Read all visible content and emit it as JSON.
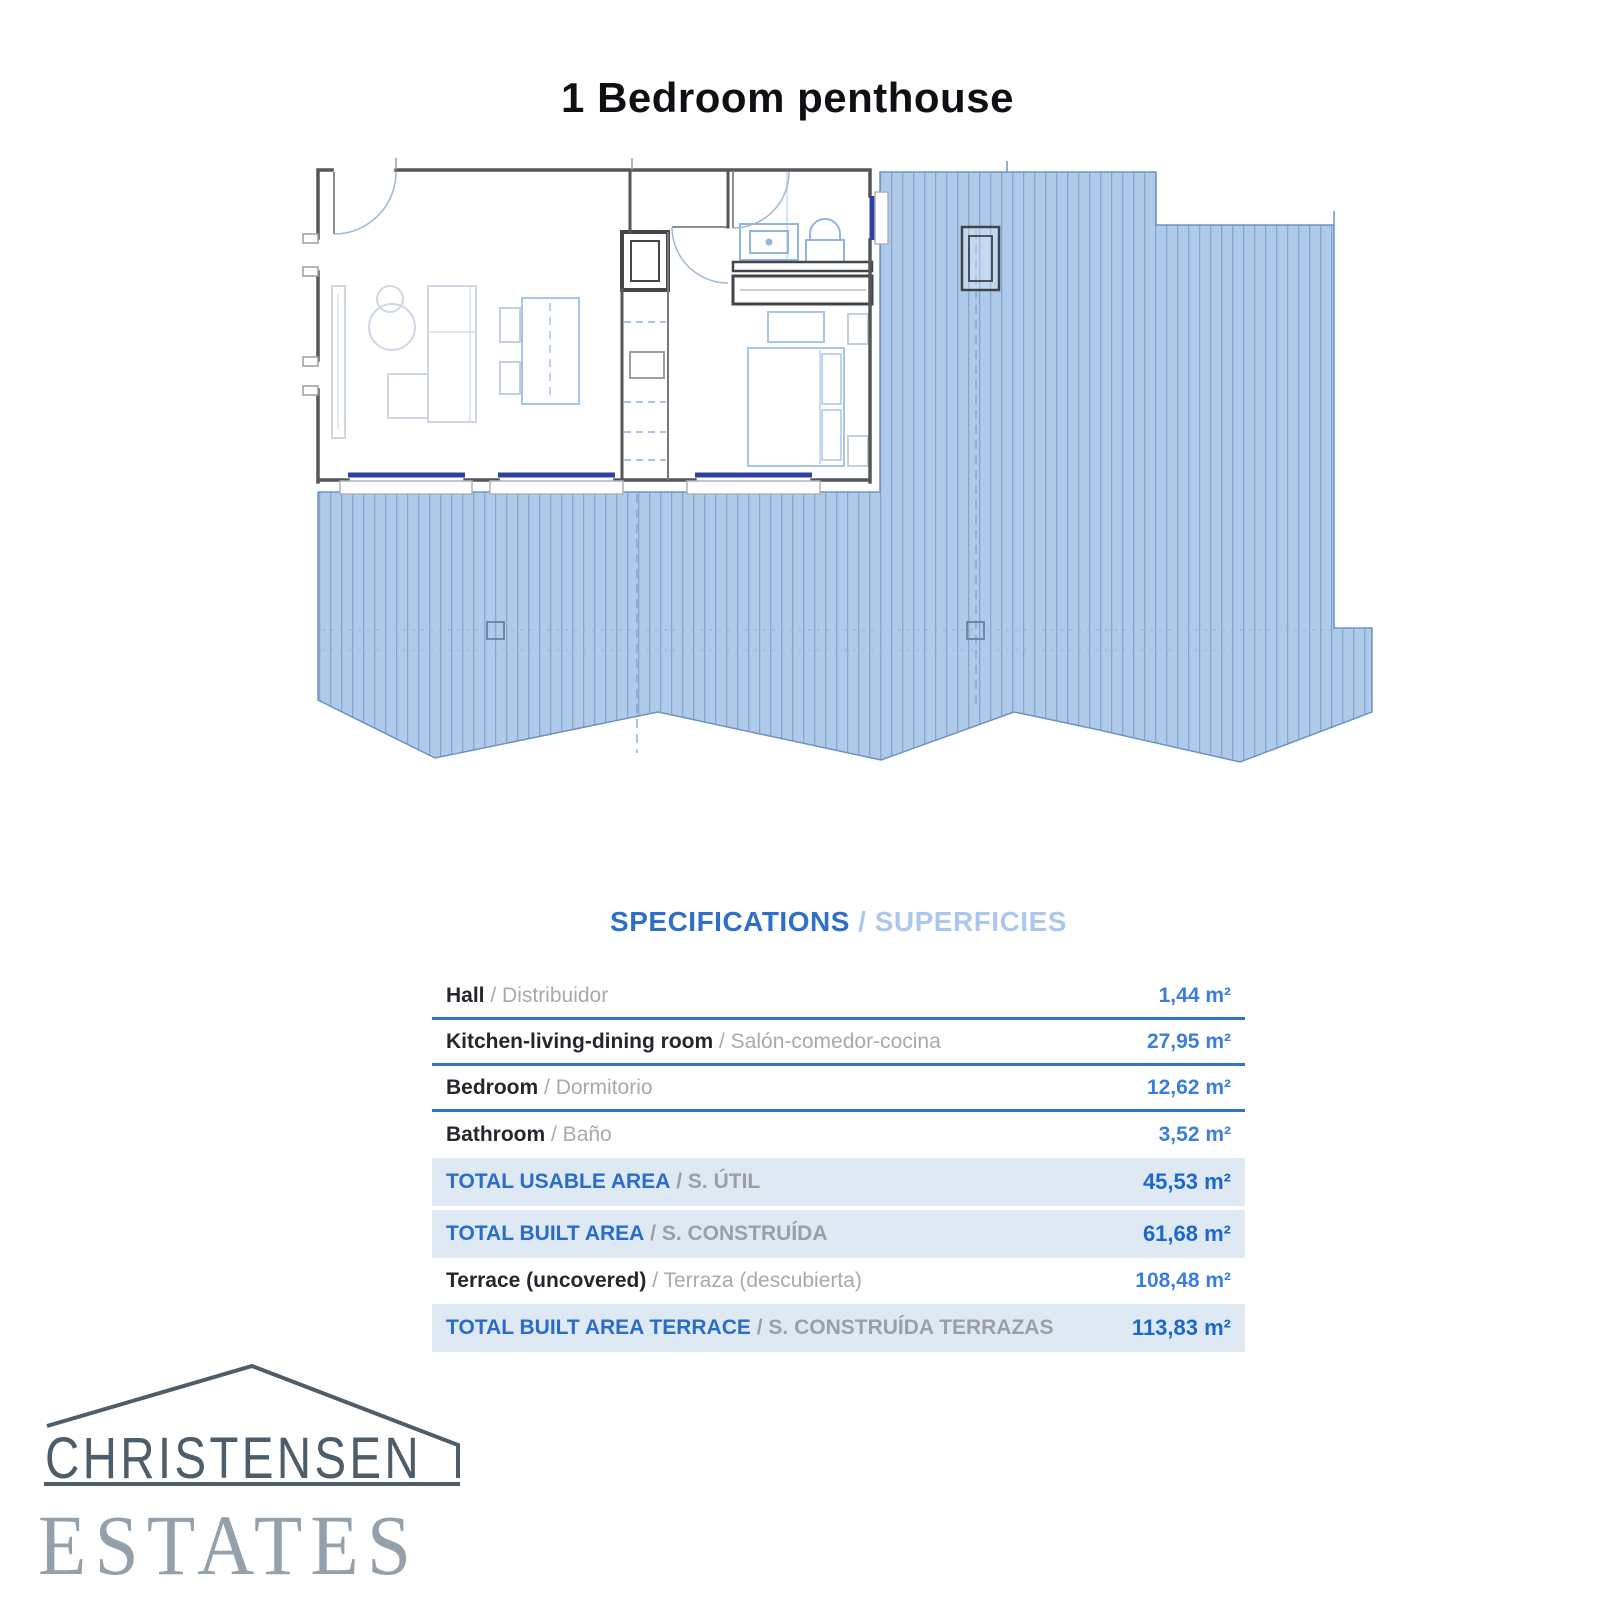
{
  "page": {
    "title": "1 Bedroom penthouse"
  },
  "specifications": {
    "heading_primary": "SPECIFICATIONS",
    "heading_separator": " / ",
    "heading_secondary": "SUPERFICIES",
    "rows": [
      {
        "label": "Hall",
        "label_alt": "/ Distribuidor",
        "value": "1,44 m²",
        "style": "normal",
        "divider": true
      },
      {
        "label": "Kitchen-living-dining room",
        "label_alt": "/ Salón-comedor-cocina",
        "value": "27,95 m²",
        "style": "normal",
        "divider": true
      },
      {
        "label": "Bedroom",
        "label_alt": "/ Dormitorio",
        "value": "12,62 m²",
        "style": "normal",
        "divider": true
      },
      {
        "label": "Bathroom",
        "label_alt": "/ Baño",
        "value": "3,52 m²",
        "style": "normal",
        "divider": false
      },
      {
        "label": "TOTAL USABLE AREA",
        "label_alt": "/ S. ÚTIL",
        "value": "45,53 m²",
        "style": "total",
        "divider": false
      },
      {
        "label": "TOTAL BUILT AREA",
        "label_alt": "/ S. CONSTRUÍDA",
        "value": "61,68 m²",
        "style": "total",
        "divider": false
      },
      {
        "label": "Terrace (uncovered)",
        "label_alt": "/ Terraza (descubierta)",
        "value": "108,48 m²",
        "style": "normal",
        "divider": false
      },
      {
        "label": "TOTAL BUILT AREA TERRACE",
        "label_alt": "/ S. CONSTRUÍDA TERRAZAS",
        "value": "113,83 m²",
        "style": "total",
        "divider": false
      }
    ]
  },
  "logo": {
    "name_top": "CHRISTENSEN",
    "name_bottom": "ESTATES"
  },
  "colors": {
    "accent_blue": "#2f6fc9",
    "heading_light_blue": "#abc8ec",
    "value_blue": "#3b7edb",
    "total_value_blue": "#1c67cb",
    "divider_blue": "#3273c9",
    "row_highlight": "#dfe9f4",
    "terrace_fill": "#b0cbea",
    "terrace_stripe": "#83a7d2",
    "window_blue": "#2e3f9f",
    "wall_gray": "#55565a",
    "logo_dark": "#4d5d6a",
    "logo_light": "#93a1ad"
  }
}
